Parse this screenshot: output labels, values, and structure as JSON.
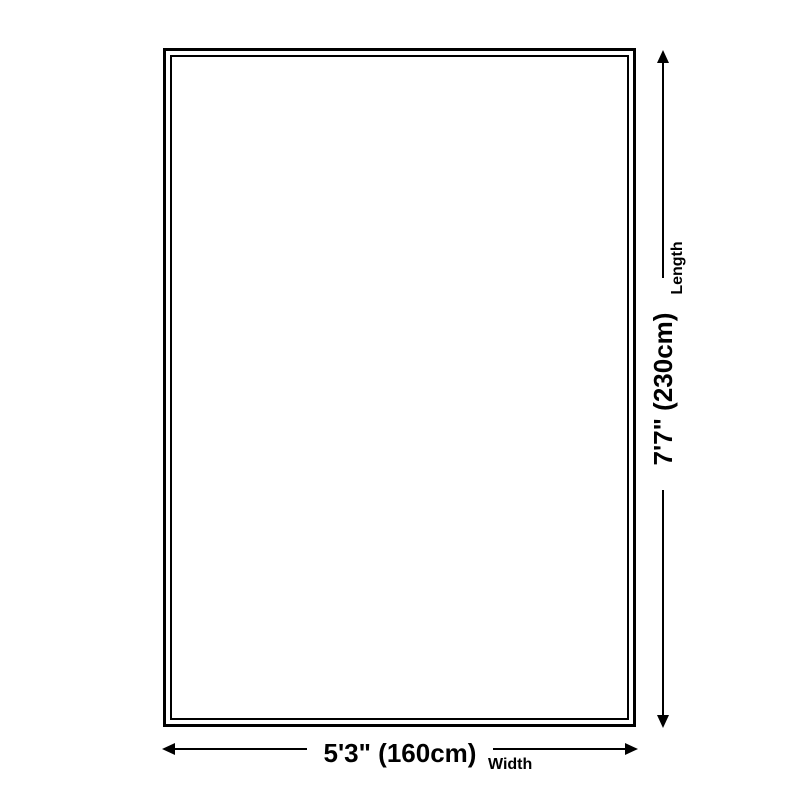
{
  "theme": {
    "background": "#ffffff",
    "ink": "#000000"
  },
  "product_diagram": {
    "dimensions": {
      "length": {
        "label": "Length",
        "value": "7'7\" (230cm)"
      },
      "width": {
        "label": "Width",
        "value": "5'3\" (160cm)"
      }
    }
  }
}
